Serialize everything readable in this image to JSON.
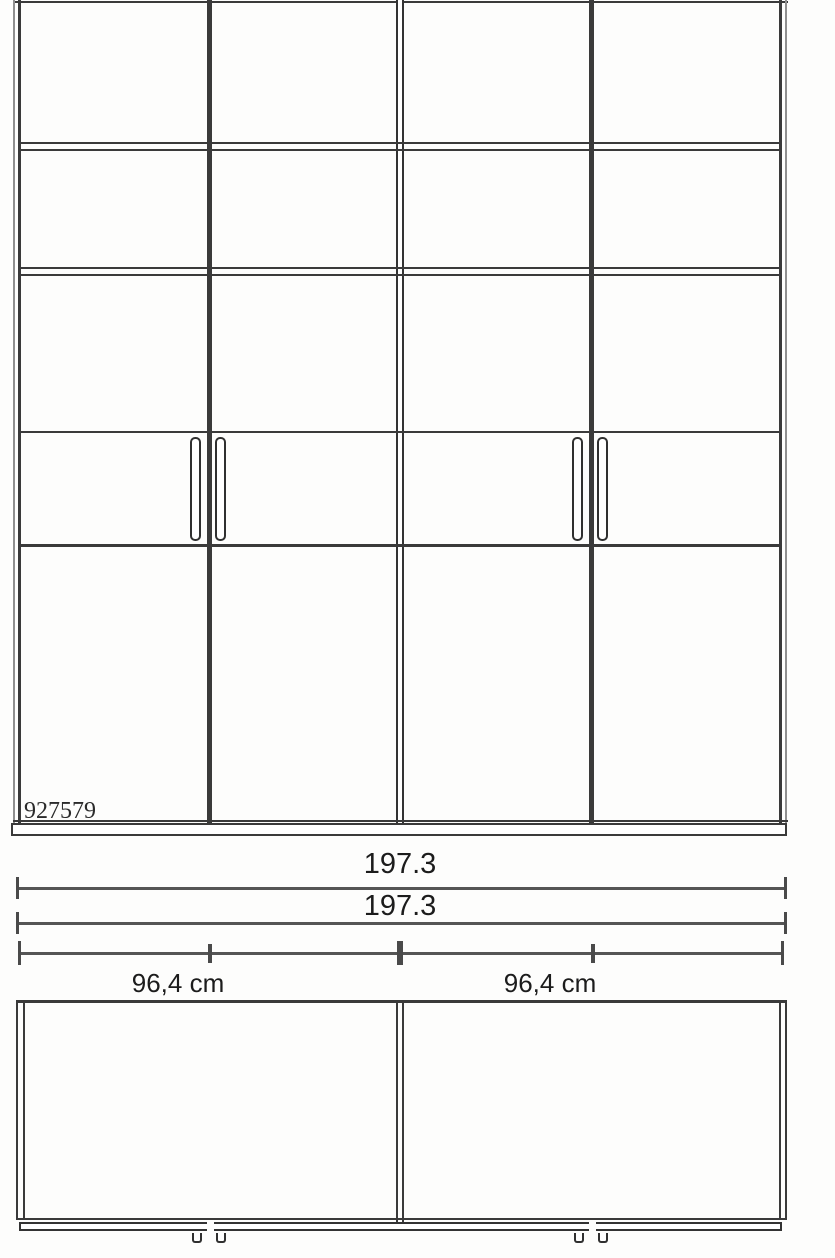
{
  "diagram": {
    "type": "furniture-technical-drawing",
    "article_number": "927579",
    "front_view": {
      "doors": 4,
      "shelf_rows": 2,
      "handle_pairs": 2
    },
    "dimensions": {
      "total_width_top": "197.3",
      "total_width_bottom": "197.3",
      "left_section_width": "96,4 cm",
      "right_section_width": "96,4 cm"
    },
    "colors": {
      "line_dark": "#3a3a3a",
      "line_gray": "#8f8f8f",
      "dimension_line": "#555555",
      "text": "#1c1c1c",
      "background": "#fdfdfc"
    }
  }
}
